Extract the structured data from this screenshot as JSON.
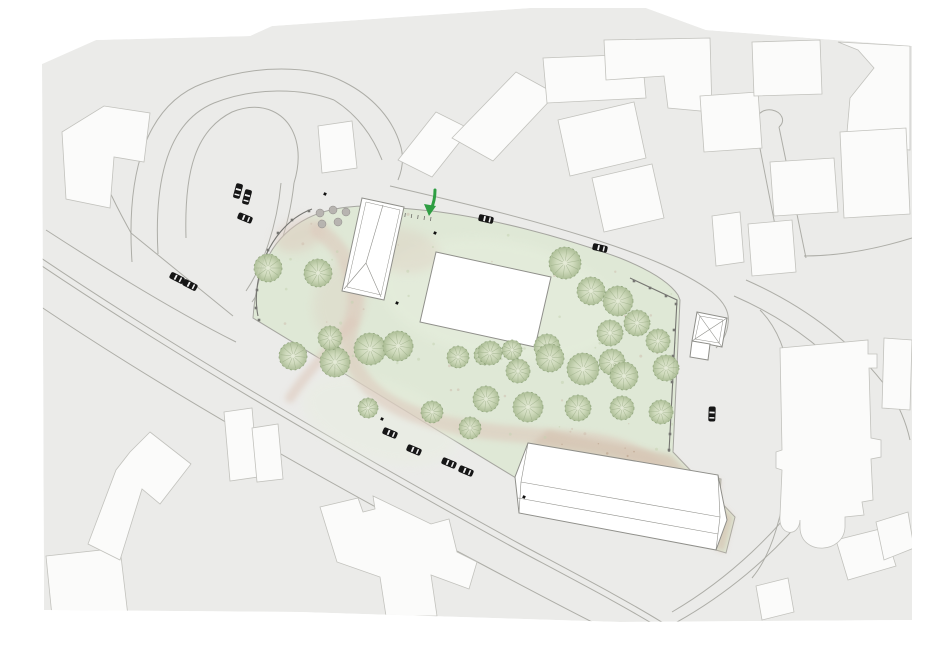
{
  "canvas": {
    "width": 950,
    "height": 662
  },
  "colors": {
    "page_bg": "#ffffff",
    "urban_bg": "#ebebe9",
    "building_fill": "#fbfbfa",
    "building_stroke": "#c2c2bd",
    "site_building_fill": "#ffffff",
    "site_building_stroke": "#8f8f8a",
    "road_stroke": "#a6a6a0",
    "park_green": "#dfe8d6",
    "park_light": "#e7efde",
    "path_pink": "#ddc9bc",
    "courtyard_tan": "#d5c4b2",
    "courtyard_dot": "#b3987f",
    "tree_edge": "#8ba077",
    "tree_line": "#90a47c",
    "tree_grad_in": "#e7ecd9",
    "tree_grad_mid": "#ccd8b8",
    "tree_grad_out": "#a9bb92",
    "planter_gray": "#b7b4b0",
    "fence_dark": "#767672",
    "car_body": "#161616",
    "car_window": "#f2f2f2",
    "mark_black": "#111111",
    "arrow_green": "#2f9e43"
  },
  "scene": {
    "base": {
      "pts": "42,64 96,40 250,36 272,26 530,8 646,8 706,30 912,46 912,620 620,622 300,612 44,610"
    },
    "park": {
      "outline": "M253,318 C256,270 272,236 308,218 C330,207 360,204 390,207 L432,211 C490,218 560,236 620,258 C645,268 668,280 678,295 L680,300 L673,452 L735,517 L726,553 L716,550 L721,479 L528,443 L516,478 Z",
      "poly": [
        [
          253,
          318
        ],
        [
          262,
          262
        ],
        [
          300,
          222
        ],
        [
          360,
          206
        ],
        [
          432,
          211
        ],
        [
          520,
          228
        ],
        [
          610,
          252
        ],
        [
          668,
          280
        ],
        [
          680,
          300
        ],
        [
          673,
          452
        ],
        [
          735,
          517
        ],
        [
          726,
          553
        ],
        [
          516,
          478
        ]
      ],
      "courtyard": "M548,430 C590,440 640,448 671,455 L733,517 L724,552 L716,549 L720,480 L530,445 Z",
      "courtyard_poly": [
        [
          548,
          430
        ],
        [
          671,
          455
        ],
        [
          733,
          517
        ],
        [
          724,
          552
        ],
        [
          640,
          520
        ],
        [
          528,
          460
        ]
      ],
      "pink_strokes": [
        {
          "d": "M318,230 C350,252 362,288 352,322 C342,352 356,388 404,410 C460,434 520,434 584,440 C628,444 656,462 676,486",
          "w": 16
        },
        {
          "d": "M352,322 C330,348 306,374 290,398",
          "w": 10
        }
      ],
      "pink_blobs": [
        {
          "cx": 300,
          "cy": 235,
          "rx": 26,
          "ry": 16,
          "rot": -20,
          "op": 0.5
        },
        {
          "cx": 400,
          "cy": 250,
          "rx": 40,
          "ry": 22,
          "rot": 10,
          "op": 0.35
        },
        {
          "cx": 340,
          "cy": 300,
          "rx": 26,
          "ry": 38,
          "rot": 15,
          "op": 0.28
        }
      ],
      "light_blobs": [
        {
          "cx": 500,
          "cy": 300,
          "rx": 120,
          "ry": 60,
          "rot": 10,
          "op": 0.5
        },
        {
          "cx": 380,
          "cy": 420,
          "rx": 80,
          "ry": 40,
          "rot": 18,
          "op": 0.4
        }
      ]
    },
    "roads": [
      "M132,262 C126,172 146,104 204,83 C256,64 312,65 344,82",
      "M158,254 C154,180 168,122 214,103 C254,87 302,88 334,100",
      "M344,82 C372,96 392,118 400,144 C404,156 403,168 398,180",
      "M334,100 C356,114 372,134 382,160",
      "M390,186 C450,200 520,216 590,238 C640,254 682,270 712,292 C724,302 730,312 728,324 C727,334 722,342 716,348",
      "M186,238 C184,170 196,130 232,112 C262,100 288,112 296,140 C300,155 298,170 294,183",
      "M294,183 C289,230 272,274 252,302",
      "M281,183 C277,226 263,266 246,291",
      "M131,233 L233,316",
      "M108,188 C117,208 124,220 131,233",
      "M46,230 C120,278 180,314 236,342",
      "M38,256 C180,352 360,456 520,544 C580,576 630,602 668,626",
      "M36,262 C178,358 358,462 518,550 C578,582 628,608 666,632",
      "M28,298 C160,388 320,478 470,558 C530,590 572,612 604,628",
      "M654,634 C720,602 780,552 820,496 C846,460 858,428 860,398",
      "M672,612 C730,578 780,530 812,482 C830,454 840,428 842,404",
      "M760,310 C780,330 790,360 792,400 C794,445 788,490 776,530 C770,550 762,566 752,578",
      "M746,280 C800,304 848,338 884,384 C898,402 906,422 910,440",
      "M734,296 C780,316 820,344 852,380 C858,387 861,392 860,398",
      "M757,133 L783,266",
      "M779,127 L806,258",
      "M757,133 C751,118 761,108 772,110 C782,112 786,121 779,127",
      "M804,256 C844,256 880,248 912,238"
    ],
    "city_buildings": [
      {
        "name": "nw-l-building",
        "pts": "62,132 104,106 150,113 144,162 114,157 110,208 66,199"
      },
      {
        "name": "nw-slab",
        "pts": "318,126 352,121 357,168 322,173"
      },
      {
        "name": "top-slab-1",
        "pts": "398,160 436,112 470,129 432,177"
      },
      {
        "name": "top-slab-2",
        "pts": "452,138 516,72 556,94 493,161"
      },
      {
        "name": "top-slab-3",
        "pts": "543,58 642,54 646,98 547,103"
      },
      {
        "name": "top-block-4",
        "pts": "558,120 634,102 646,158 570,176"
      },
      {
        "name": "top-block-5",
        "pts": "592,178 652,164 664,218 604,232"
      },
      {
        "name": "tr-big-1",
        "pts": "604,40 710,38 712,112 668,108 664,76 606,80"
      },
      {
        "name": "tr-slab-2",
        "pts": "700,96 758,92 762,148 704,152"
      },
      {
        "name": "tr-slab-3",
        "pts": "752,42 820,40 822,94 754,96"
      },
      {
        "name": "tr-corner",
        "pts": "838,42 910,46 910,150 846,144 850,98 874,68 858,50"
      },
      {
        "name": "r-slab-1",
        "pts": "770,162 834,158 838,212 774,216"
      },
      {
        "name": "r-big-2",
        "pts": "840,132 906,128 910,214 844,218"
      },
      {
        "name": "r-small-1",
        "pts": "712,216 740,212 744,262 716,266"
      },
      {
        "name": "r-small-2",
        "pts": "748,224 792,220 796,272 752,276"
      },
      {
        "name": "r-edge-slab",
        "pts": "884,338 912,340 910,410 882,408"
      },
      {
        "name": "br-slab-1",
        "pts": "836,540 884,528 896,566 848,580"
      },
      {
        "name": "br-slab-2",
        "pts": "876,522 908,512 914,548 884,560"
      },
      {
        "name": "br-small",
        "pts": "756,586 788,578 794,612 762,620"
      },
      {
        "name": "bl-building",
        "pts": "46,556 120,548 128,616 52,616"
      },
      {
        "name": "b-cross-building",
        "pts": "320,507 358,498 363,512 375,509 373,496 431,524 449,519 457,552 477,562 469,589 431,575 437,616 386,616 380,577 337,562"
      },
      {
        "name": "l-diamond-building",
        "pts": "150,432 191,464 160,504 142,489 120,560 88,544 116,470 130,452"
      },
      {
        "name": "l-pair-1",
        "pts": "224,412 252,408 258,477 230,481"
      },
      {
        "name": "l-pair-2",
        "pts": "252,428 278,424 283,479 257,482"
      }
    ],
    "church_path": "M780,348 L868,340 L868,354 L877,354 L877,368 L869,368 L871,438 L881,440 L881,457 L871,459 L873,500 L862,502 L864,515 L845,517 L845,527 C844,554 801,556 800,528 L800,520 C799,538 778,536 780,516 L782,470 L776,468 L776,452 L782,450 Z",
    "chapel": {
      "outline": "362,198 404,207 384,300 342,291",
      "inner": "366,202 400,210 381,295 347,287",
      "roof_lines": [
        "M383,205 L366,263",
        "M366,263 L344,289",
        "M366,263 L381,297"
      ]
    },
    "hall": {
      "outline": "436,252 551,277 535,347 420,322"
    },
    "long_building": {
      "outline": "528,443 718,475 727,520 716,550 519,513 515,477",
      "roof_lines": [
        "M521,482 L720,517",
        "M518,498 L718,534",
        "M521,482 L528,443",
        "M521,482 L519,513",
        "M720,517 L718,475",
        "M720,517 L716,550"
      ]
    },
    "pavilion": {
      "outline": "697,312 727,318 722,347 692,341",
      "inner": "700,316 723,320 719,343 695,339",
      "diag": [
        "M697,312 L722,347",
        "M727,318 L692,341"
      ],
      "annex": "692,341 710,344 708,360 690,357"
    },
    "fences": [
      {
        "d": "M312,209 C288,218 270,240 261,268 C256,286 255,302 258,316",
        "posts": [
          [
            309,
            211
          ],
          [
            292,
            220
          ],
          [
            278,
            233
          ],
          [
            268,
            250
          ],
          [
            261,
            270
          ],
          [
            257,
            290
          ],
          [
            256,
            308
          ],
          [
            259,
            320
          ]
        ]
      },
      {
        "d": "M630,278 L677,300 L669,452",
        "posts": [
          [
            634,
            281
          ],
          [
            650,
            288
          ],
          [
            666,
            296
          ],
          [
            676,
            304
          ],
          [
            674,
            330
          ],
          [
            673,
            356
          ],
          [
            672,
            382
          ],
          [
            671,
            408
          ],
          [
            670,
            434
          ],
          [
            669,
            450
          ]
        ]
      }
    ],
    "hatch": {
      "x1": 399,
      "y1": 212,
      "x2": 431,
      "y2": 217,
      "count": 6
    },
    "trees": [
      [
        268,
        268,
        14
      ],
      [
        318,
        273,
        14
      ],
      [
        565,
        263,
        16
      ],
      [
        591,
        291,
        14
      ],
      [
        618,
        301,
        15
      ],
      [
        637,
        323,
        13
      ],
      [
        293,
        356,
        14
      ],
      [
        335,
        362,
        15
      ],
      [
        370,
        349,
        16
      ],
      [
        398,
        346,
        15
      ],
      [
        330,
        338,
        12
      ],
      [
        458,
        357,
        11
      ],
      [
        484,
        355,
        10
      ],
      [
        512,
        350,
        10
      ],
      [
        547,
        347,
        13
      ],
      [
        610,
        333,
        13
      ],
      [
        612,
        362,
        13
      ],
      [
        490,
        353,
        12
      ],
      [
        518,
        371,
        12
      ],
      [
        550,
        358,
        14
      ],
      [
        583,
        369,
        16
      ],
      [
        624,
        376,
        14
      ],
      [
        666,
        368,
        13
      ],
      [
        658,
        341,
        12
      ],
      [
        486,
        399,
        13
      ],
      [
        528,
        407,
        15
      ],
      [
        578,
        408,
        13
      ],
      [
        622,
        408,
        12
      ],
      [
        661,
        412,
        12
      ],
      [
        470,
        428,
        11
      ],
      [
        432,
        412,
        11
      ],
      [
        368,
        408,
        10
      ]
    ],
    "planters": [
      [
        320,
        213
      ],
      [
        333,
        210
      ],
      [
        346,
        212
      ],
      [
        322,
        224
      ],
      [
        338,
        222
      ]
    ],
    "cars": [
      [
        238,
        191,
        105
      ],
      [
        247,
        197,
        105
      ],
      [
        245,
        218,
        22
      ],
      [
        177,
        278,
        27
      ],
      [
        190,
        285,
        27
      ],
      [
        486,
        219,
        13
      ],
      [
        600,
        248,
        13
      ],
      [
        712,
        414,
        92
      ],
      [
        390,
        433,
        23
      ],
      [
        414,
        450,
        23
      ],
      [
        449,
        463,
        23
      ],
      [
        466,
        471,
        23
      ]
    ],
    "marks": [
      [
        325,
        194
      ],
      [
        435,
        233
      ],
      [
        397,
        303
      ],
      [
        382,
        419
      ],
      [
        524,
        497
      ]
    ],
    "arrow": {
      "shaft": "M435,190 C435,198 434,203 431,209",
      "head": "424,204 436,206 429,216"
    }
  }
}
